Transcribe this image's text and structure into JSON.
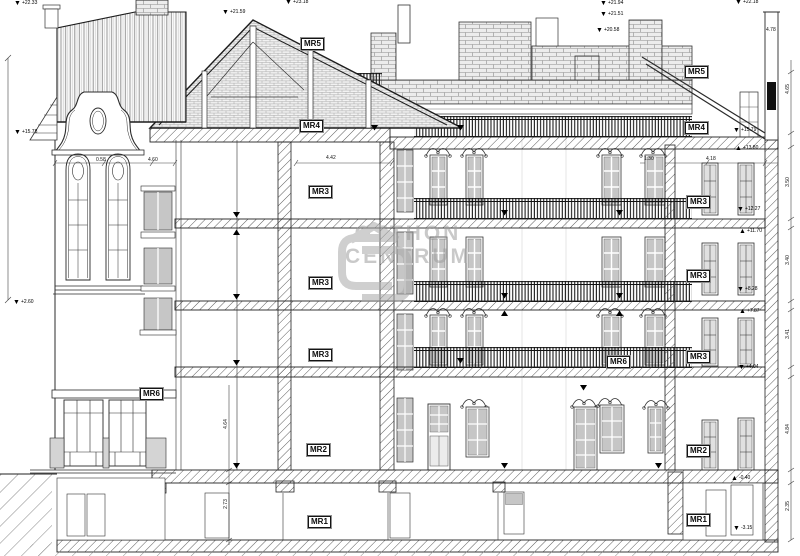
{
  "watermark": {
    "line1": "OTTHON",
    "line2": "CENTRUM"
  },
  "room_labels": [
    {
      "text": "MR5",
      "x": 301,
      "y": 38
    },
    {
      "text": "MR4",
      "x": 300,
      "y": 120
    },
    {
      "text": "MR3",
      "x": 309,
      "y": 186
    },
    {
      "text": "MR3",
      "x": 309,
      "y": 277
    },
    {
      "text": "MR3",
      "x": 309,
      "y": 349
    },
    {
      "text": "MR6",
      "x": 140,
      "y": 388
    },
    {
      "text": "MR2",
      "x": 307,
      "y": 444
    },
    {
      "text": "MR1",
      "x": 308,
      "y": 516
    },
    {
      "text": "MR5",
      "x": 685,
      "y": 66
    },
    {
      "text": "MR4",
      "x": 685,
      "y": 122
    },
    {
      "text": "MR3",
      "x": 687,
      "y": 196
    },
    {
      "text": "MR3",
      "x": 687,
      "y": 270
    },
    {
      "text": "MR3",
      "x": 687,
      "y": 351
    },
    {
      "text": "MR6",
      "x": 607,
      "y": 356
    },
    {
      "text": "MR2",
      "x": 687,
      "y": 445
    },
    {
      "text": "MR1",
      "x": 687,
      "y": 514
    }
  ],
  "elevation_markers": [
    {
      "value": "+22.33",
      "tri": "▼",
      "x": 14,
      "y": 1
    },
    {
      "value": "+21.59",
      "tri": "▼",
      "x": 222,
      "y": 10
    },
    {
      "value": "+23.18",
      "tri": "▼",
      "x": 285,
      "y": 0
    },
    {
      "value": "+21.94",
      "tri": "▼",
      "x": 600,
      "y": 1
    },
    {
      "value": "+21.51",
      "tri": "▼",
      "x": 600,
      "y": 12
    },
    {
      "value": "+20.58",
      "tri": "▼",
      "x": 596,
      "y": 28
    },
    {
      "value": "+22.18",
      "tri": "▼",
      "x": 735,
      "y": 0
    },
    {
      "value": "+15.78",
      "tri": "▼",
      "x": 14,
      "y": 130
    },
    {
      "value": "+2.60",
      "tri": "▼",
      "x": 13,
      "y": 300
    },
    {
      "value": "+15.79",
      "tri": "▼",
      "x": 733,
      "y": 128
    },
    {
      "value": "+13.80",
      "tri": "▲",
      "x": 735,
      "y": 146
    },
    {
      "value": "+12.27",
      "tri": "▼",
      "x": 737,
      "y": 207
    },
    {
      "value": "+11.70",
      "tri": "▲",
      "x": 739,
      "y": 229
    },
    {
      "value": "+8.28",
      "tri": "▼",
      "x": 737,
      "y": 287
    },
    {
      "value": "+7.87",
      "tri": "▲",
      "x": 739,
      "y": 309
    },
    {
      "value": "+4.04",
      "tri": "▼",
      "x": 738,
      "y": 365
    },
    {
      "value": "-0.40",
      "tri": "▲",
      "x": 731,
      "y": 476
    },
    {
      "value": "-3.15",
      "tri": "▼",
      "x": 733,
      "y": 526
    }
  ],
  "dimensions": {
    "horizontal": [
      {
        "value": "0.58",
        "x": 96,
        "y": 157
      },
      {
        "value": "4.60",
        "x": 148,
        "y": 157
      },
      {
        "value": "4.42",
        "x": 326,
        "y": 155
      },
      {
        "value": "1.30",
        "x": 644,
        "y": 156
      },
      {
        "value": "4.18",
        "x": 706,
        "y": 156
      },
      {
        "value": "4.78",
        "x": 766,
        "y": 27
      }
    ],
    "vertical": [
      {
        "value": "4.65",
        "x": 783,
        "y": 86
      },
      {
        "value": "3.50",
        "x": 783,
        "y": 179
      },
      {
        "value": "3.40",
        "x": 783,
        "y": 257
      },
      {
        "value": "3.41",
        "x": 783,
        "y": 331
      },
      {
        "value": "4.84",
        "x": 783,
        "y": 426
      },
      {
        "value": "2.35",
        "x": 783,
        "y": 503
      },
      {
        "value": "4.64",
        "x": 221,
        "y": 421
      },
      {
        "value": "2.73",
        "x": 221,
        "y": 501
      }
    ]
  },
  "colors": {
    "paper": "#ffffff",
    "ink": "#2b2b2b",
    "glass": "#c6c6c6",
    "watermark": "#9e9e9e"
  }
}
